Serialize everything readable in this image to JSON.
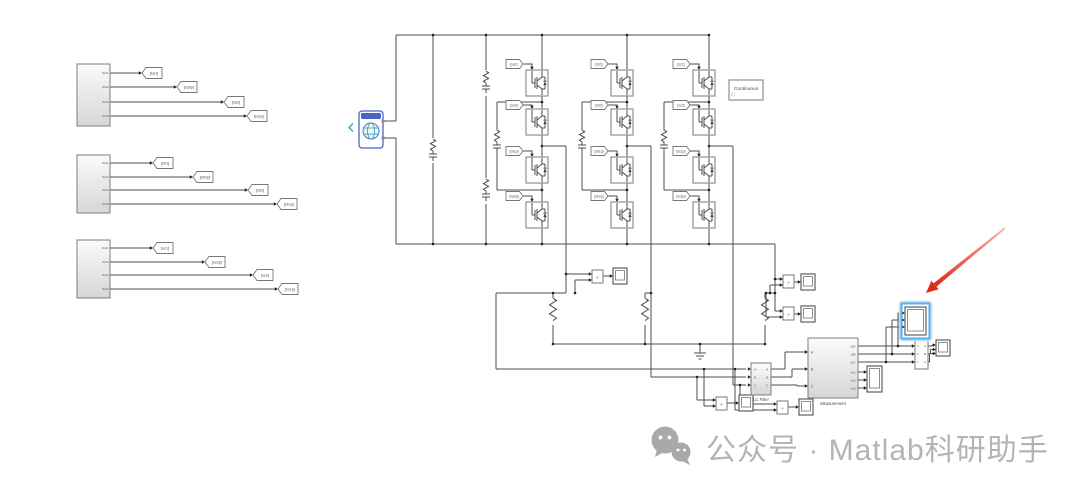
{
  "watermark": {
    "text": "公众号 · Matlab科研助手",
    "icon": "wechat-bubbles-icon"
  },
  "powergui": {
    "label": "Continuous"
  },
  "subsystem_port_labels": [
    "Out1",
    "Out2",
    "Out3",
    "Out4"
  ],
  "goto_tags": [
    [
      "[sa1]",
      "[sa2p]",
      "[sa2]",
      "[sa1p]"
    ],
    [
      "[sb1]",
      "[sb2p]",
      "[sb2]",
      "[sb1p]"
    ],
    [
      "[sc1]",
      "[sc2p]",
      "[sc2]",
      "[sc1p]"
    ]
  ],
  "from_tags": [
    [
      "[sa1]",
      "[sa2]",
      "[sa1p]",
      "[sa2p]"
    ],
    [
      "[sb1]",
      "[sb2]",
      "[sb1p]",
      "[sb2p]"
    ],
    [
      "[sc1]",
      "[sc2]",
      "[sc1p]",
      "[sc2p]"
    ]
  ],
  "vm_label": "v",
  "lc_filter": {
    "label": "LC Filter",
    "ports": [
      "A",
      "B",
      "C"
    ]
  },
  "measurement": {
    "label": "Measurement",
    "inputs": [
      "A",
      "B",
      "C"
    ],
    "outputs": [
      "vSA",
      "vSB",
      "vSC",
      "Vs1",
      "Vs2",
      "Vs3"
    ]
  },
  "abc_block": {
    "left": [
      "a",
      "b",
      "c"
    ],
    "right": [
      "A",
      "B",
      "C"
    ]
  },
  "colors": {
    "wire": "#4c4c4c",
    "selection": "#57aeee",
    "annotation_arrow": "#e02818",
    "powergui_text": "#3c5cd8",
    "battery": "#4a63c8",
    "watermark": "#b4b4b4"
  }
}
